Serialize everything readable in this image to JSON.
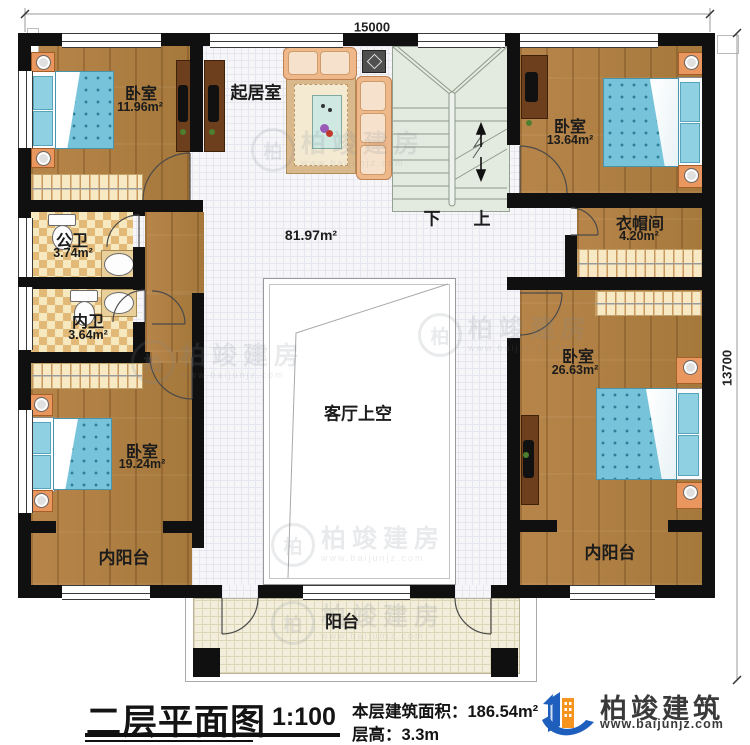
{
  "plan": {
    "dimensions": {
      "top": "15000",
      "right": "13700"
    },
    "rooms": [
      {
        "id": "bedroom-tl",
        "label": "卧室",
        "area": "11.96m²"
      },
      {
        "id": "living",
        "label": "起居室",
        "area": "81.97m²"
      },
      {
        "id": "bedroom-tr",
        "label": "卧室",
        "area": "13.64m²"
      },
      {
        "id": "public-bath",
        "label": "公卫",
        "area": "3.74m²"
      },
      {
        "id": "inner-bath",
        "label": "内卫",
        "area": "3.64m²"
      },
      {
        "id": "cloakroom",
        "label": "衣帽间",
        "area": "4.20m²"
      },
      {
        "id": "bedroom-right",
        "label": "卧室",
        "area": "26.63m²"
      },
      {
        "id": "bedroom-bl",
        "label": "卧室",
        "area": "19.24m²"
      },
      {
        "id": "inner-balcony-left",
        "label": "内阳台"
      },
      {
        "id": "inner-balcony-right",
        "label": "内阳台"
      },
      {
        "id": "balcony",
        "label": "阳台"
      },
      {
        "id": "void",
        "label": "客厅上空"
      }
    ],
    "stairs": {
      "down": "下",
      "up": "上"
    }
  },
  "titleblock": {
    "title": "二层平面图",
    "scale": "1:100",
    "area_label": "本层建筑面积：",
    "area_value": "186.54m²",
    "floor_height_label": "层高：",
    "floor_height_value": "3.3m"
  },
  "brand": {
    "name": "柏竣建筑",
    "website": "www.baijunjz.com"
  },
  "watermark": {
    "symbol": "柏",
    "text": "柏竣建房",
    "website": "www.baijunjz.com"
  },
  "colors": {
    "wall": "#101010",
    "wood": "#b28045",
    "bed_blue": "#77c4da",
    "bath_checker": "#e2b977",
    "stair": "#e3eadf",
    "balcony": "#f2eedb",
    "brand_blue": "#1e5fbe",
    "brand_orange": "#f7941d"
  }
}
